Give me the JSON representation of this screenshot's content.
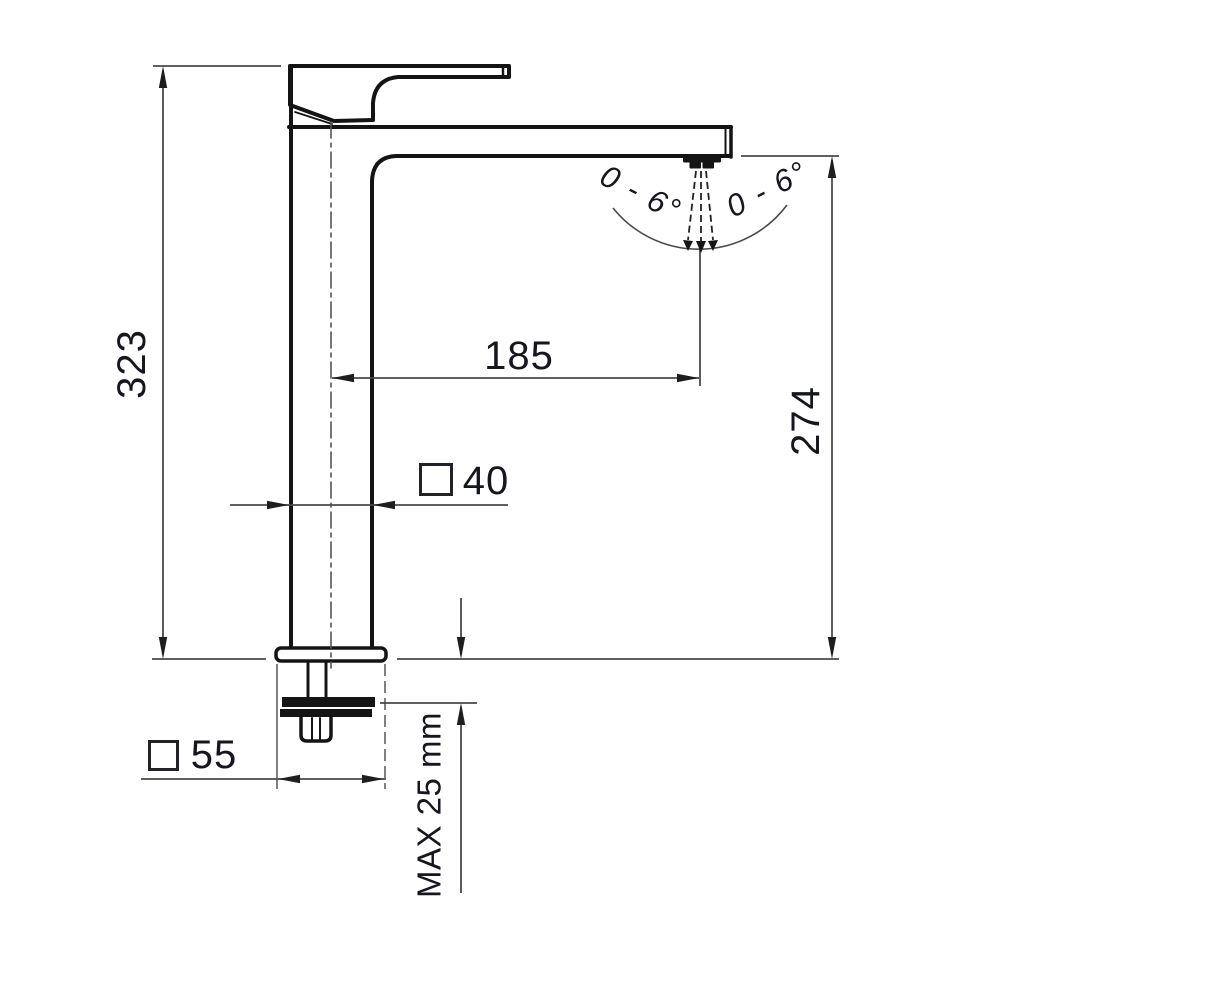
{
  "title": "Basin mixer tap dimensional drawing",
  "dimensions": {
    "total_height": "323",
    "spout_reach": "185",
    "spout_outlet_height": "274",
    "body_square_width": "40",
    "base_square_width": "55",
    "max_deck_thickness": "MAX 25 mm",
    "aerator_tilt_left": "0 - 6°",
    "aerator_tilt_right": "0 - 6°"
  },
  "colors": {
    "outline": "#141414",
    "dimension_line": "#4a4a4a",
    "text": "#16161e"
  }
}
